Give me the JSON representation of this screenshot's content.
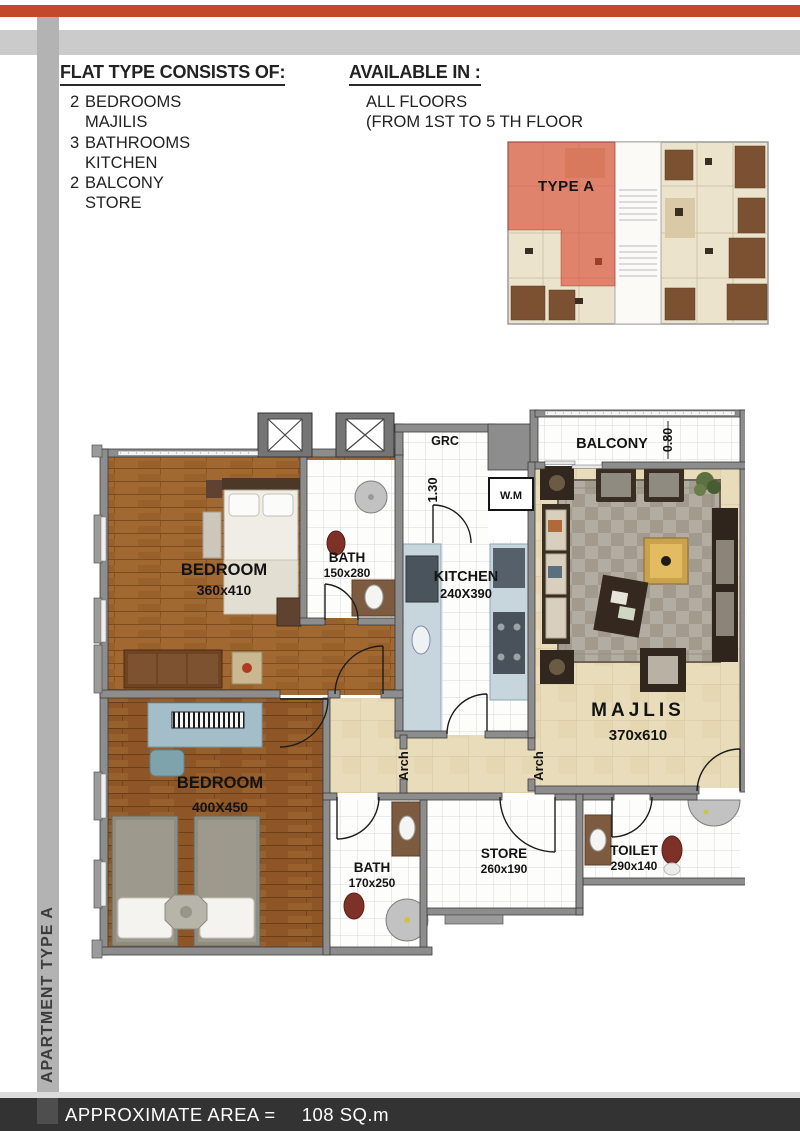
{
  "colors": {
    "accent": "#c3492b",
    "top_gray_bar": "#cbcbcb",
    "sidebar_gray": "#b3b3b3",
    "footer_bg": "#333333",
    "mini_plan_highlight": "#d74832",
    "wood_floor": "#a16831",
    "marble_floor": "#e8dcba",
    "wall_gray": "#8d8d8d"
  },
  "sidebar": {
    "label": "APARTMENT TYPE A"
  },
  "header": {
    "consists": {
      "title": "FLAT TYPE CONSISTS OF:",
      "items": [
        {
          "num": "2",
          "label": "BEDROOMS"
        },
        {
          "num": "",
          "label": "MAJILIS"
        },
        {
          "num": "3",
          "label": "BATHROOMS"
        },
        {
          "num": "",
          "label": "KITCHEN"
        },
        {
          "num": "2",
          "label": "BALCONY"
        },
        {
          "num": "",
          "label": "STORE"
        }
      ]
    },
    "available": {
      "title": "AVAILABLE IN :",
      "lines": [
        "ALL FLOORS",
        "(FROM 1ST TO 5 TH FLOOR"
      ]
    }
  },
  "mini_plan": {
    "label": "TYPE A"
  },
  "floor_plan": {
    "rooms": {
      "bedroom1": {
        "name": "BEDROOM",
        "dims": "360x410"
      },
      "bath1": {
        "name": "BATH",
        "dims": "150x280"
      },
      "kitchen": {
        "name": "KITCHEN",
        "dims": "240X390"
      },
      "balcony": {
        "name": "BALCONY"
      },
      "majlis": {
        "name": "MAJLIS",
        "dims": "370x610"
      },
      "bedroom2": {
        "name": "BEDROOM",
        "dims": "400X450"
      },
      "bath2": {
        "name": "BATH",
        "dims": "170x250"
      },
      "store": {
        "name": "STORE",
        "dims": "260x190"
      },
      "toilet": {
        "name": "TOILET",
        "dims": "290x140"
      }
    },
    "labels": {
      "grc": "GRC",
      "wm": "W.M",
      "arch1": "Arch",
      "arch2": "Arch",
      "dim_corridor": "1.30",
      "dim_balcony": "0.80"
    }
  },
  "footer": {
    "label": "APPROXIMATE AREA =",
    "value": "108 SQ.m"
  }
}
